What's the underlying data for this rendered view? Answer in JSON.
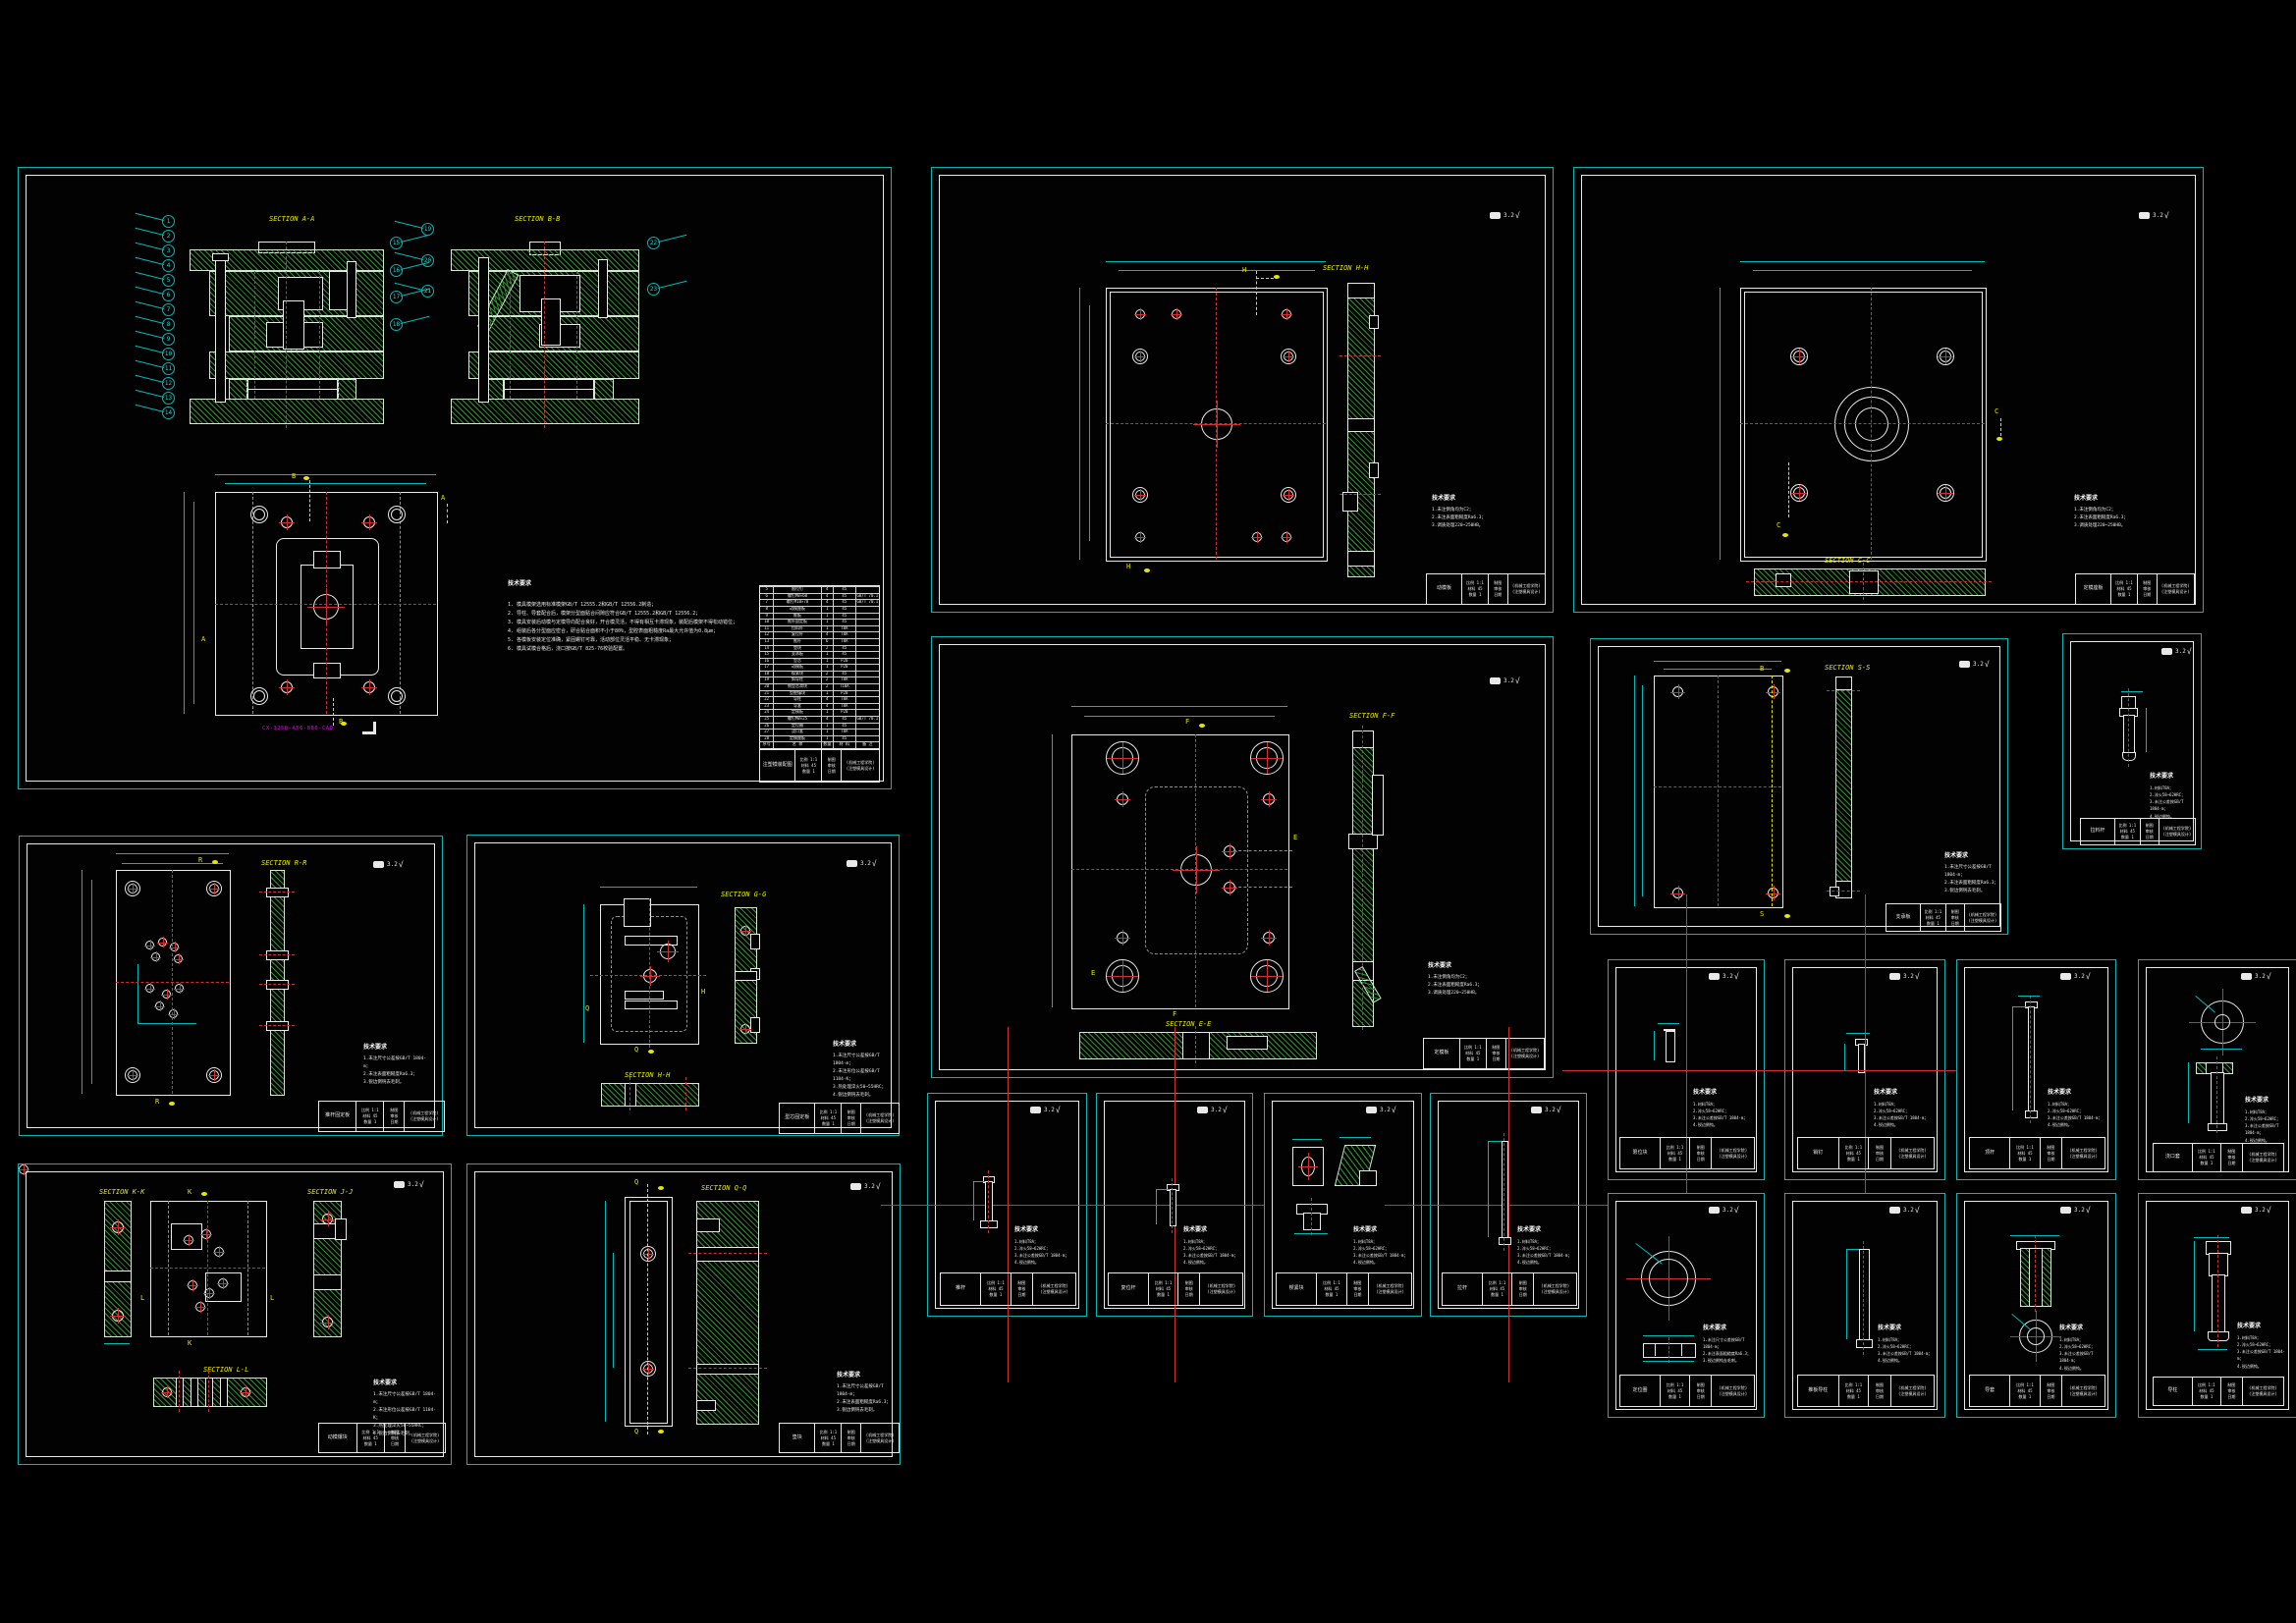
{
  "palette": {
    "background": "#000000",
    "sheet_frame": "#0fb3b3",
    "drawing_line": "#e8e8e8",
    "hatch": "#2f8f2f",
    "centerline": "#cd3131",
    "dimension": "#00b8b8",
    "section_label": "#e6e600",
    "part_number": "#e800e8"
  },
  "shared": {
    "finish": "3.2",
    "finish_check": "√",
    "tech_title": "技术要求",
    "notes3": [
      "1.未注尺寸公差按GB/T 1804-m；",
      "2.未注表面粗糙度Ra6.3；",
      "3.锐边倒钝去毛刺。"
    ],
    "notes4": [
      "1.未注尺寸公差按GB/T 1804-m；",
      "2.未注形位公差按GB/T 1184-K；",
      "3.热处理淬火50~55HRC；",
      "4.锐边倒钝去毛刺。"
    ],
    "plate_notes": [
      "1.未注倒角均为C2；",
      "2.未注表面粗糙度Ra6.3；",
      "3.调质处理220~250HB。"
    ],
    "small_notes": [
      "1.材料T8A；",
      "2.淬火58~62HRC；",
      "3.未注公差按GB/T 1804-m；",
      "4.锐边倒钝。"
    ],
    "tb": {
      "meta_lines": [
        "比例 1:1",
        "材料 45",
        "数量 1"
      ],
      "sign_lines": [
        "制图",
        "审核",
        "日期"
      ],
      "org_lines": [
        "(机械工程学院)",
        "(注塑模具设计)"
      ]
    }
  },
  "sheets": {
    "assembly": {
      "name": "注塑模装配图",
      "part_no": "CX-325D-A56-886-CAD",
      "sections": [
        "SECTION A-A",
        "SECTION B-B"
      ],
      "marker_a": "A",
      "marker_b": "B",
      "notes": [
        "1. 模具模架选用标准模架GB/T 12555.2和GB/T 12556.2制造；",
        "2. 导柱、导套配合后，模架分型面贴合间隙应符合GB/T 12555.2和GB/T 12556.2；",
        "3. 模具安装后动模与定模导向配合良好，开合模灵活，不得有相互卡滞现象，装配后模架不得松动错位；",
        "4. 组装后各分型面应密合，研合贴合面积不小于80%，型腔表面粗糙度Ra最大允许值为0.8μm；",
        "5. 各模板安装定位准确，紧固螺钉可靠，活动部位灵活平稳、无卡滞现象；",
        "6. 模具试模合格后，浇口按GB/T 825-76校验配置。"
      ],
      "balloons_left": [
        "1",
        "2",
        "3",
        "4",
        "5",
        "6",
        "7",
        "8",
        "9",
        "10",
        "11",
        "12",
        "13",
        "14"
      ],
      "balloons_right": [
        "15",
        "16",
        "17",
        "18"
      ],
      "balloons_bb": [
        "19",
        "20",
        "21"
      ],
      "balloons_top": [
        "22",
        "23"
      ],
      "bom": {
        "headers": [
          "序号",
          "名 称",
          "数量",
          "材 料",
          "备 注"
        ],
        "rows": [
          [
            "28",
            "定模座板",
            "1",
            "45",
            ""
          ],
          [
            "27",
            "浇口套",
            "1",
            "T8A",
            ""
          ],
          [
            "26",
            "定位圈",
            "1",
            "45",
            ""
          ],
          [
            "25",
            "螺钉M8×25",
            "4",
            "45",
            "GB/T 70.1"
          ],
          [
            "24",
            "定模板",
            "1",
            "P20",
            ""
          ],
          [
            "23",
            "导套",
            "4",
            "T8A",
            ""
          ],
          [
            "22",
            "导柱",
            "4",
            "T8A",
            ""
          ],
          [
            "21",
            "型腔镶块",
            "1",
            "P20",
            ""
          ],
          [
            "20",
            "侧型芯滑块",
            "2",
            "T10A",
            ""
          ],
          [
            "19",
            "斜导柱",
            "2",
            "T8A",
            ""
          ],
          [
            "18",
            "楔紧块",
            "2",
            "45",
            ""
          ],
          [
            "17",
            "动模板",
            "1",
            "P20",
            ""
          ],
          [
            "16",
            "型芯",
            "1",
            "P20",
            ""
          ],
          [
            "15",
            "支承板",
            "1",
            "45",
            ""
          ],
          [
            "14",
            "垫块",
            "2",
            "45",
            ""
          ],
          [
            "13",
            "推杆",
            "6",
            "T8A",
            ""
          ],
          [
            "12",
            "复位杆",
            "4",
            "T8A",
            ""
          ],
          [
            "11",
            "拉料杆",
            "1",
            "T8A",
            ""
          ],
          [
            "10",
            "推杆固定板",
            "1",
            "45",
            ""
          ],
          [
            "9",
            "推板",
            "1",
            "45",
            ""
          ],
          [
            "8",
            "动模座板",
            "1",
            "45",
            ""
          ],
          [
            "7",
            "螺钉M10×70",
            "4",
            "45",
            "GB/T 70.1"
          ],
          [
            "6",
            "螺钉M8×60",
            "4",
            "45",
            "GB/T 70.1"
          ],
          [
            "5",
            "限位钉",
            "4",
            "45",
            ""
          ],
          [
            "4",
            "弹簧",
            "4",
            "65Mn",
            ""
          ],
          [
            "3",
            "销钉",
            "4",
            "T8A",
            ""
          ],
          [
            "2",
            "水嘴",
            "4",
            "黄铜",
            ""
          ],
          [
            "1",
            "密封圈",
            "4",
            "橡胶",
            ""
          ]
        ]
      }
    },
    "s2": {
      "name": "推杆固定板",
      "section": "SECTION R-R",
      "m": "R"
    },
    "s3": {
      "name": "型芯固定板",
      "sections": [
        "SECTION G-G",
        "SECTION H-H"
      ],
      "m1": "Q",
      "m2": "H"
    },
    "s4": {
      "name": "动模镶块",
      "sections": [
        "SECTION K-K",
        "SECTION J-J",
        "SECTION L-L"
      ],
      "m1": "K",
      "m2": "L"
    },
    "s5": {
      "name": "垫块",
      "section": "SECTION Q-Q",
      "m": "Q"
    },
    "s6": {
      "name": "动模板",
      "section": "SECTION H-H",
      "m": "H"
    },
    "s7": {
      "name": "定模座板",
      "section": "SECTION C-C",
      "m": "C"
    },
    "s8": {
      "name": "定模板",
      "sections": [
        "SECTION F-F",
        "SECTION E-E"
      ],
      "m1": "F",
      "m2": "E"
    },
    "s9": {
      "name": "支承板",
      "section": "SECTION S-S",
      "m1": "B",
      "m2": "S"
    },
    "s10": {
      "name": "拉料杆"
    },
    "d1": {
      "name": "推杆"
    },
    "d2": {
      "name": "复位杆"
    },
    "d3": {
      "name": "楔紧块"
    },
    "d4": {
      "name": "拉杆"
    },
    "e1": {
      "name": "限位块"
    },
    "e2": {
      "name": "销钉"
    },
    "e3": {
      "name": "顶杆"
    },
    "e4": {
      "name": "浇口套"
    },
    "e5": {
      "name": "定位圈"
    },
    "e6": {
      "name": "推板导柱"
    },
    "e7": {
      "name": "导套"
    },
    "e8": {
      "name": "导柱"
    }
  }
}
